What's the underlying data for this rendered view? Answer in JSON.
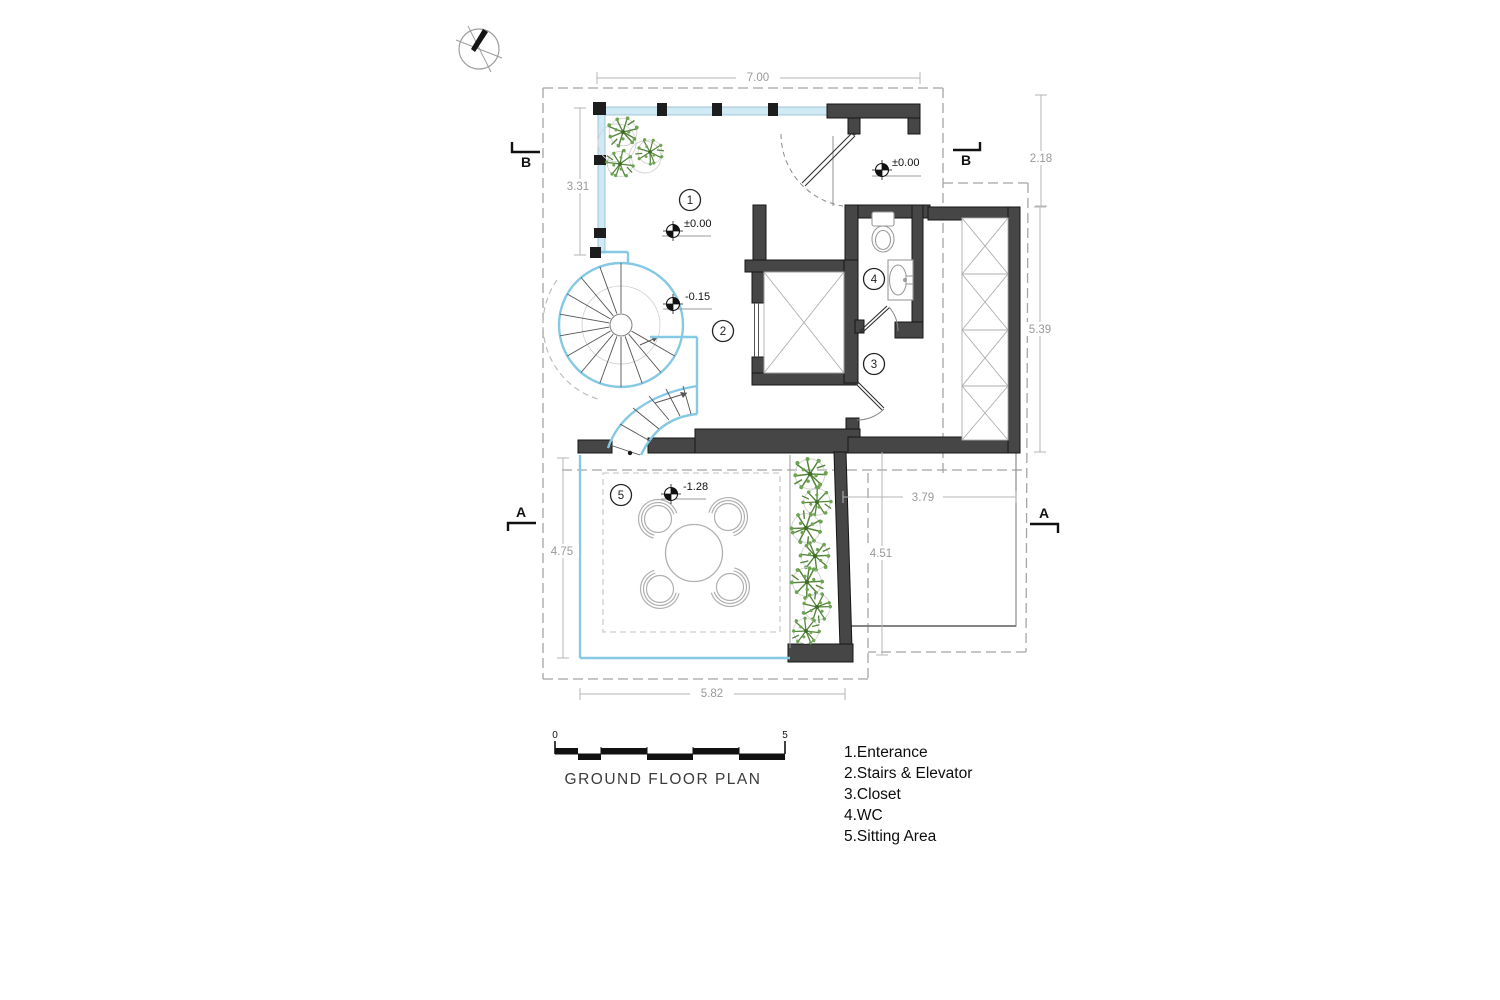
{
  "title": "GROUND FLOOR PLAN",
  "scale_bar": {
    "start": "0",
    "end": "5"
  },
  "legend": {
    "items": [
      "1.Enterance",
      "2.Stairs & Elevator",
      "3.Closet",
      "4.WC",
      "5.Sitting Area"
    ]
  },
  "rooms": {
    "entrance": "1",
    "stairs_elevator": "2",
    "closet": "3",
    "wc": "4",
    "sitting_area": "5"
  },
  "levels": {
    "entry_door": "±0.00",
    "entrance_room": "±0.00",
    "stair_landing": "-0.15",
    "sitting_area": "-1.28"
  },
  "dimensions": {
    "top_width": "7.00",
    "right_top": "2.18",
    "left_glazing": "3.31",
    "right_closet": "5.39",
    "terrace_width": "3.79",
    "terrace_height": "4.51",
    "sitting_height": "4.75",
    "bottom_width": "5.82"
  },
  "section_markers": {
    "b_left": "B",
    "b_right": "B",
    "a_left": "A",
    "a_right": "A"
  },
  "icons": {
    "north_arrow": "compass-north-needle"
  },
  "colors": {
    "wall": "#464646",
    "glass_line": "#85c9e4",
    "plant_green": "#5b8f3f",
    "dimension_gray": "#999999"
  }
}
